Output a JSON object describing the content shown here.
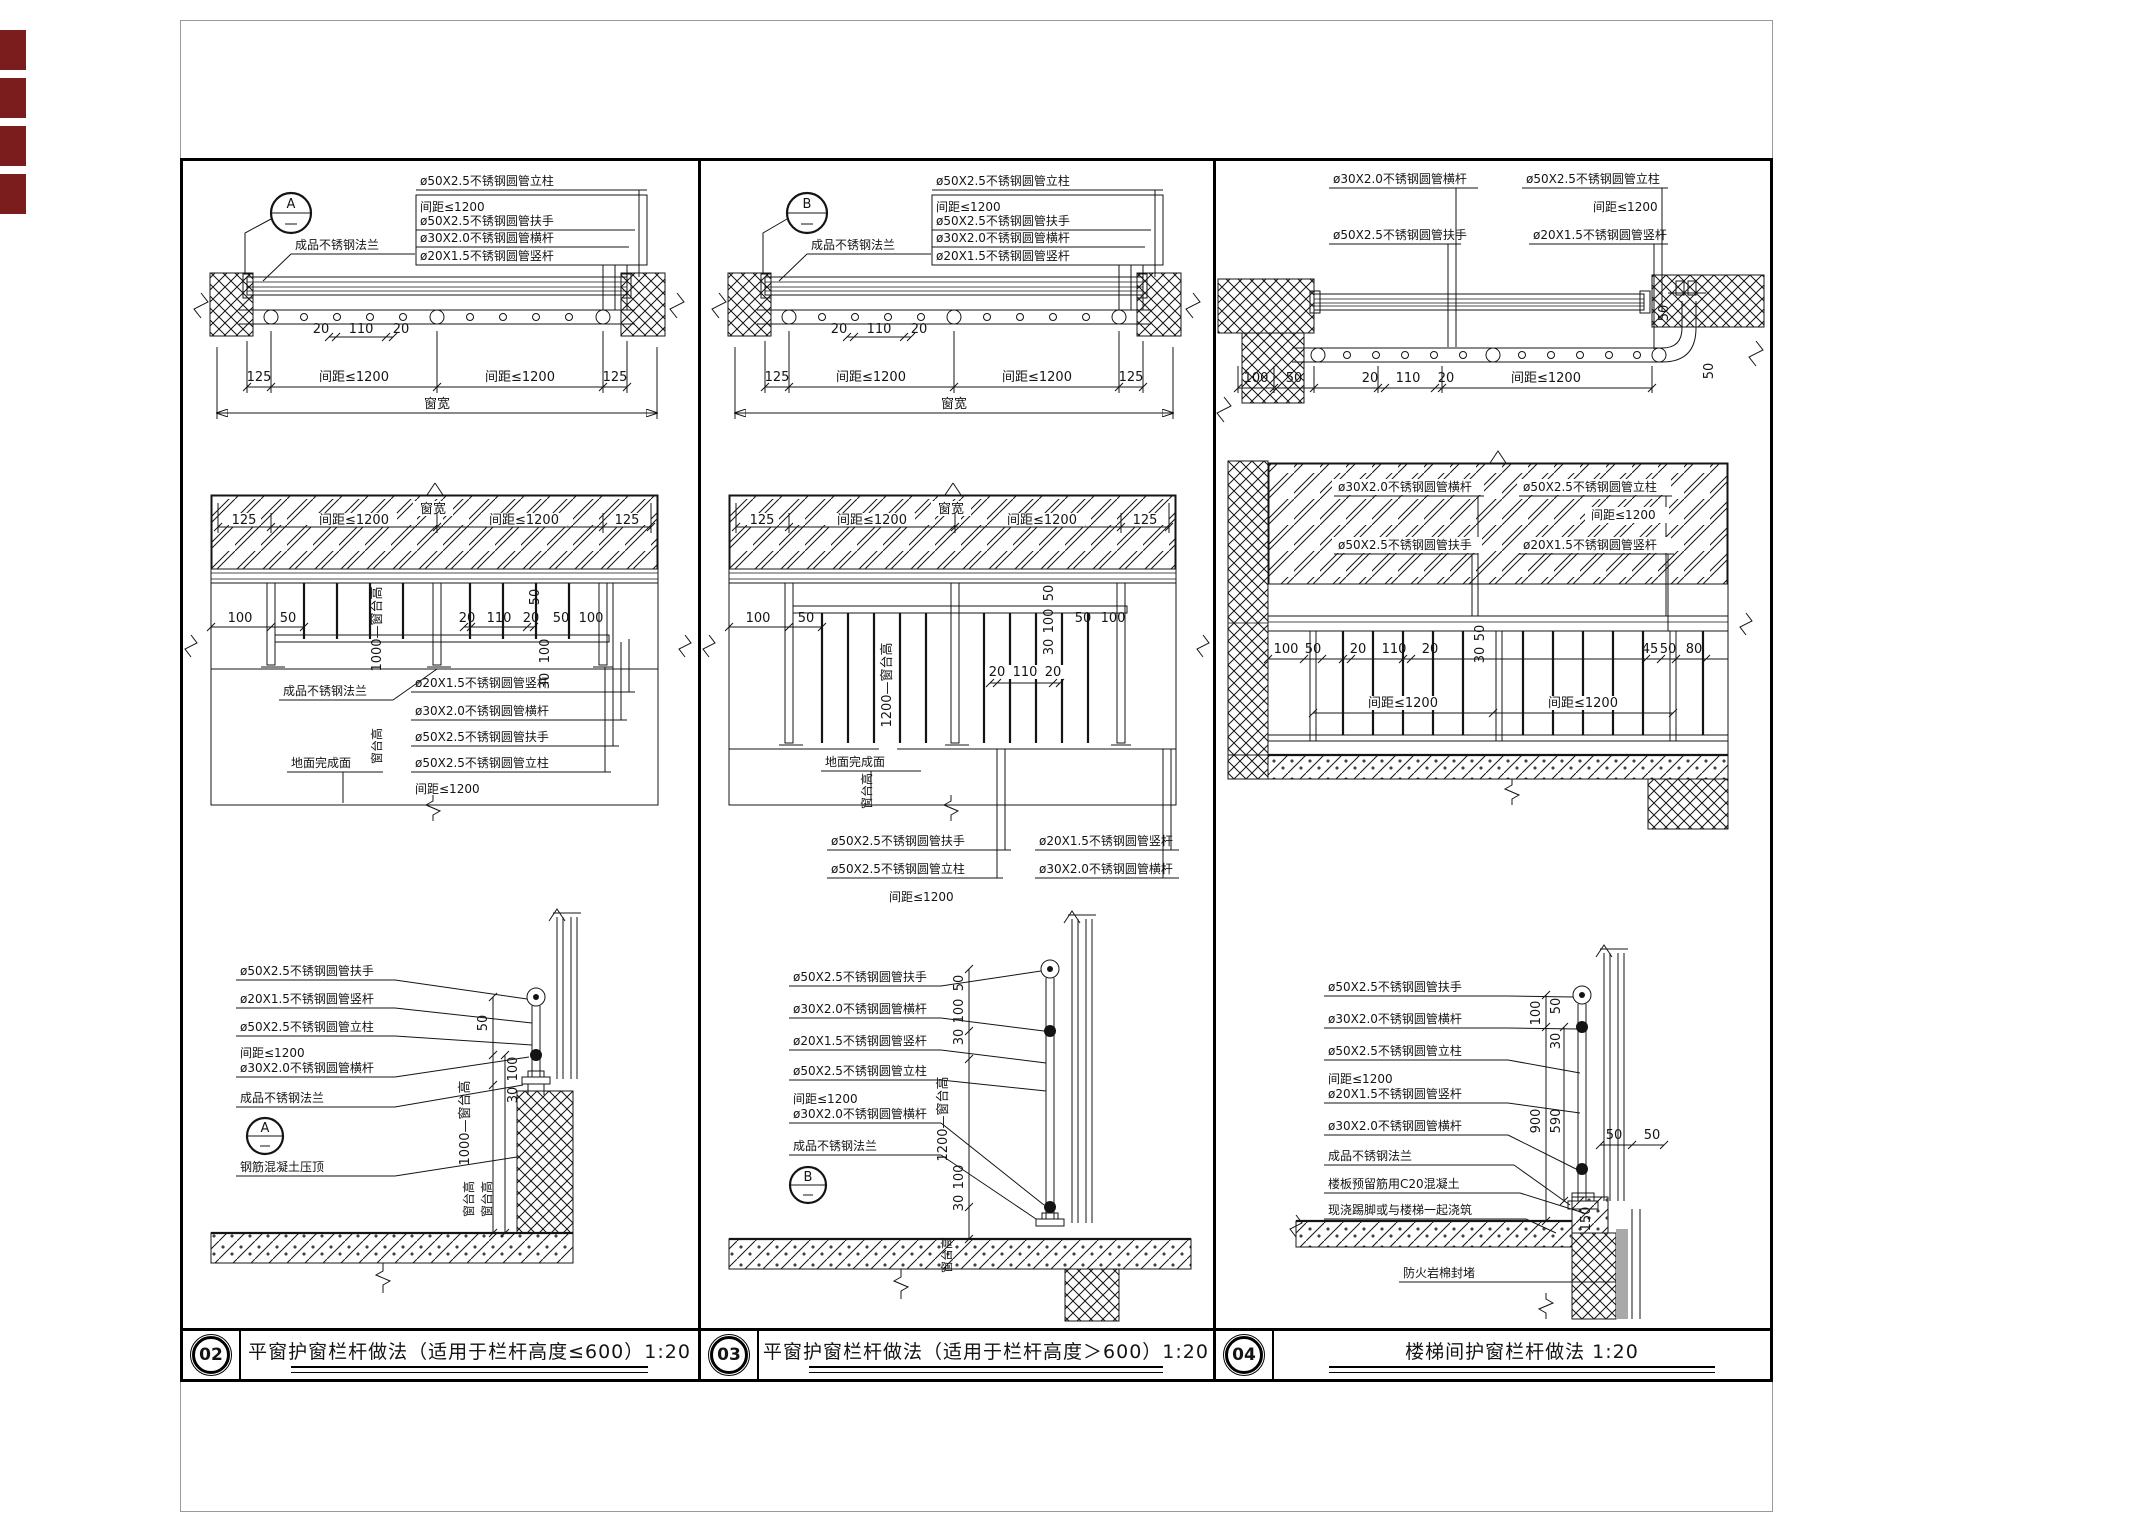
{
  "page": {
    "line_color": "#000000",
    "paper_border_color": "#9a9a9a",
    "edge_mark_color": "#7b1d1d",
    "background": "#ffffff"
  },
  "materials": {
    "post": "ø50X2.5不锈钢圆管立柱",
    "handrail": "ø50X2.5不锈钢圆管扶手",
    "crossbar": "ø30X2.0不锈钢圆管横杆",
    "baluster": "ø20X1.5不锈钢圆管竖杆",
    "spacing": "间距≤1200",
    "flange": "成品不锈钢法兰"
  },
  "annotations": {
    "floor_finish": "地面完成面",
    "coping": "钢筋混凝土压顶",
    "slab_infill": "楼板预留筋用C20混凝土",
    "cast_skirt": "现浇踢脚或与楼梯一起浇筑",
    "firestop": "防火岩棉封堵",
    "window_width": "窗宽",
    "sill_height": "窗台高",
    "sill_h1000": "1000—窗台高",
    "sill_h1200": "1200—窗台高"
  },
  "dims": {
    "d125": "125",
    "d100": "100",
    "d50": "50",
    "d45": "45",
    "d80": "80",
    "d20": "20",
    "d110": "110",
    "d30": "30",
    "d900": "900",
    "d590": "590",
    "d150": "150"
  },
  "marks": {
    "a": "A",
    "b": "B"
  },
  "frame": {
    "panels": [
      {
        "number": "02",
        "title": "平窗护窗栏杆做法（适用于栏杆高度≤600）1:20"
      },
      {
        "number": "03",
        "title": "平窗护窗栏杆做法（适用于栏杆高度＞600）1:20"
      },
      {
        "number": "04",
        "title": "楼梯间护窗栏杆做法  1:20"
      }
    ]
  }
}
